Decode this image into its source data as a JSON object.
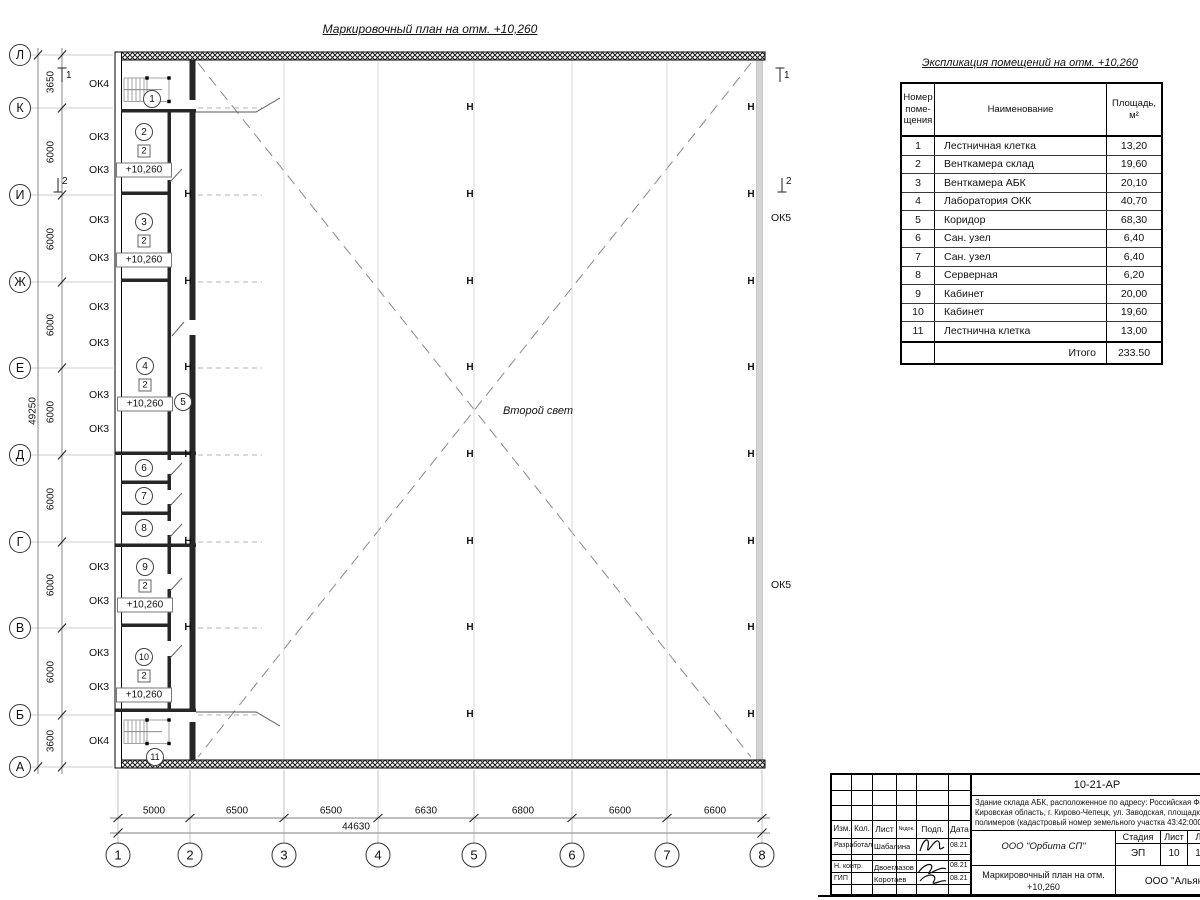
{
  "drawing_title": "Маркировочный план на отм. +10,260",
  "labels": {
    "second_light": "Второй свет"
  },
  "axes": {
    "rows": [
      {
        "label": "Л",
        "y": 55
      },
      {
        "label": "К",
        "y": 108
      },
      {
        "label": "И",
        "y": 195
      },
      {
        "label": "Ж",
        "y": 282
      },
      {
        "label": "Е",
        "y": 368
      },
      {
        "label": "Д",
        "y": 455
      },
      {
        "label": "Г",
        "y": 542
      },
      {
        "label": "В",
        "y": 628
      },
      {
        "label": "Б",
        "y": 715
      },
      {
        "label": "А",
        "y": 767
      }
    ],
    "cols": [
      {
        "label": "1",
        "x": 118
      },
      {
        "label": "2",
        "x": 190
      },
      {
        "label": "3",
        "x": 284
      },
      {
        "label": "4",
        "x": 378
      },
      {
        "label": "5",
        "x": 474
      },
      {
        "label": "6",
        "x": 572
      },
      {
        "label": "7",
        "x": 667
      },
      {
        "label": "8",
        "x": 762
      }
    ]
  },
  "dimensions": {
    "row_segments": [
      {
        "value": "3650",
        "y": 82
      },
      {
        "value": "6000",
        "y": 152
      },
      {
        "value": "6000",
        "y": 239
      },
      {
        "value": "6000",
        "y": 325
      },
      {
        "value": "6000",
        "y": 412
      },
      {
        "value": "6000",
        "y": 499
      },
      {
        "value": "6000",
        "y": 585
      },
      {
        "value": "6000",
        "y": 672
      },
      {
        "value": "3600",
        "y": 741
      }
    ],
    "rows_total": {
      "value": "49250",
      "x": 33,
      "y": 411
    },
    "col_segments": [
      {
        "value": "5000",
        "x": 154
      },
      {
        "value": "6500",
        "x": 237
      },
      {
        "value": "6500",
        "x": 331
      },
      {
        "value": "6630",
        "x": 426
      },
      {
        "value": "6800",
        "x": 523
      },
      {
        "value": "6600",
        "x": 620
      },
      {
        "value": "6600",
        "x": 715
      }
    ],
    "cols_total": {
      "value": "44630",
      "x": 356,
      "y": 827
    }
  },
  "window_tags": [
    {
      "text": "ОК4",
      "x": 99,
      "y": 84,
      "side": "left"
    },
    {
      "text": "ОК3",
      "x": 99,
      "y": 137,
      "side": "left"
    },
    {
      "text": "ОК3",
      "x": 99,
      "y": 170,
      "side": "left"
    },
    {
      "text": "ОК3",
      "x": 99,
      "y": 220,
      "side": "left"
    },
    {
      "text": "ОК3",
      "x": 99,
      "y": 258,
      "side": "left"
    },
    {
      "text": "ОК3",
      "x": 99,
      "y": 307,
      "side": "left"
    },
    {
      "text": "ОК3",
      "x": 99,
      "y": 343,
      "side": "left"
    },
    {
      "text": "ОК3",
      "x": 99,
      "y": 395,
      "side": "left"
    },
    {
      "text": "ОК3",
      "x": 99,
      "y": 429,
      "side": "left"
    },
    {
      "text": "ОК3",
      "x": 99,
      "y": 567,
      "side": "left"
    },
    {
      "text": "ОК3",
      "x": 99,
      "y": 601,
      "side": "left"
    },
    {
      "text": "ОК3",
      "x": 99,
      "y": 653,
      "side": "left"
    },
    {
      "text": "ОК3",
      "x": 99,
      "y": 687,
      "side": "left"
    },
    {
      "text": "ОК4",
      "x": 99,
      "y": 741,
      "side": "left"
    },
    {
      "text": "ОК5",
      "x": 781,
      "y": 218,
      "side": "right"
    },
    {
      "text": "ОК5",
      "x": 781,
      "y": 585,
      "side": "right"
    }
  ],
  "section_marks": [
    {
      "label": "1",
      "x": 68,
      "y": 77,
      "dir": "up"
    },
    {
      "label": "2",
      "x": 64,
      "y": 183,
      "dir": "down"
    },
    {
      "label": "1",
      "x": 786,
      "y": 77,
      "dir": "up"
    },
    {
      "label": "2",
      "x": 788,
      "y": 183,
      "dir": "down"
    }
  ],
  "rooms": [
    {
      "num": "1",
      "x": 152,
      "y": 99
    },
    {
      "num": "2",
      "x": 144,
      "y": 132,
      "type": "2",
      "elev": "+10,260"
    },
    {
      "num": "3",
      "x": 144,
      "y": 222,
      "type": "2",
      "elev": "+10,260"
    },
    {
      "num": "4",
      "x": 145,
      "y": 366,
      "type": "2",
      "elev": "+10,260"
    },
    {
      "num": "5",
      "x": 183,
      "y": 402
    },
    {
      "num": "6",
      "x": 144,
      "y": 468
    },
    {
      "num": "7",
      "x": 144,
      "y": 496
    },
    {
      "num": "8",
      "x": 144,
      "y": 528
    },
    {
      "num": "9",
      "x": 145,
      "y": 567,
      "type": "2",
      "elev": "+10,260"
    },
    {
      "num": "10",
      "x": 144,
      "y": 657,
      "type": "2",
      "elev": "+10,260"
    },
    {
      "num": "11",
      "x": 155,
      "y": 757
    }
  ],
  "steel_columns": {
    "center_x": 470,
    "right_x": 751,
    "wall_x": 188,
    "center_rows": [
      108,
      195,
      282,
      368,
      455,
      542,
      628,
      715
    ],
    "wall_rows": [
      195,
      282,
      368,
      455,
      542,
      628
    ]
  },
  "schedule": {
    "title": "Экспликация помещений на отм. +10,260",
    "headers": [
      "Номер\nпоме-\nщения",
      "Наименование",
      "Площадь,\nм²"
    ],
    "rows": [
      {
        "num": "1",
        "name": "Лестничная клетка",
        "area": "13,20"
      },
      {
        "num": "2",
        "name": "Венткамера склад",
        "area": "19,60"
      },
      {
        "num": "3",
        "name": "Венткамера АБК",
        "area": "20,10"
      },
      {
        "num": "4",
        "name": "Лаборатория ОКК",
        "area": "40,70"
      },
      {
        "num": "5",
        "name": "Коридор",
        "area": "68,30"
      },
      {
        "num": "6",
        "name": "Сан. узел",
        "area": "6,40"
      },
      {
        "num": "7",
        "name": "Сан. узел",
        "area": "6,40"
      },
      {
        "num": "8",
        "name": "Серверная",
        "area": "6,20"
      },
      {
        "num": "9",
        "name": "Кабинет",
        "area": "20,00"
      },
      {
        "num": "10",
        "name": "Кабинет",
        "area": "19,60"
      },
      {
        "num": "11",
        "name": "Лестнична клетка",
        "area": "13,00"
      }
    ],
    "total_label": "Итого",
    "total_value": "233.50"
  },
  "titleblock": {
    "code": "10-21-АР",
    "description": "Здание склада АБК, расположенное по адресу: Российская Феде\nКировская область, г. Кирово-Чепецк, ул. Заводская, площадка з\nполимеров (кадастровый номер земельного участка 43:42:0000",
    "columns_header": [
      "Изм.",
      "Кол.",
      "Лист",
      "№док.",
      "Подп.",
      "Дата"
    ],
    "staff": [
      {
        "role": "Разработал",
        "name": "Шабалина",
        "date": "08.21"
      },
      {
        "role": "Н. контр.",
        "name": "Двоеглазов",
        "date": "08.21"
      },
      {
        "role": "ГИП",
        "name": "Коротаев",
        "date": "08.21"
      }
    ],
    "org": "ООО \"Орбита СП\"",
    "stage_headers": [
      "Стадия",
      "Лист",
      "Листов"
    ],
    "stage_values": [
      "ЭП",
      "10",
      "1"
    ],
    "sheet_title": "Маркировочный план на отм.\n+10,260",
    "company": "ООО \"Альянс"
  }
}
